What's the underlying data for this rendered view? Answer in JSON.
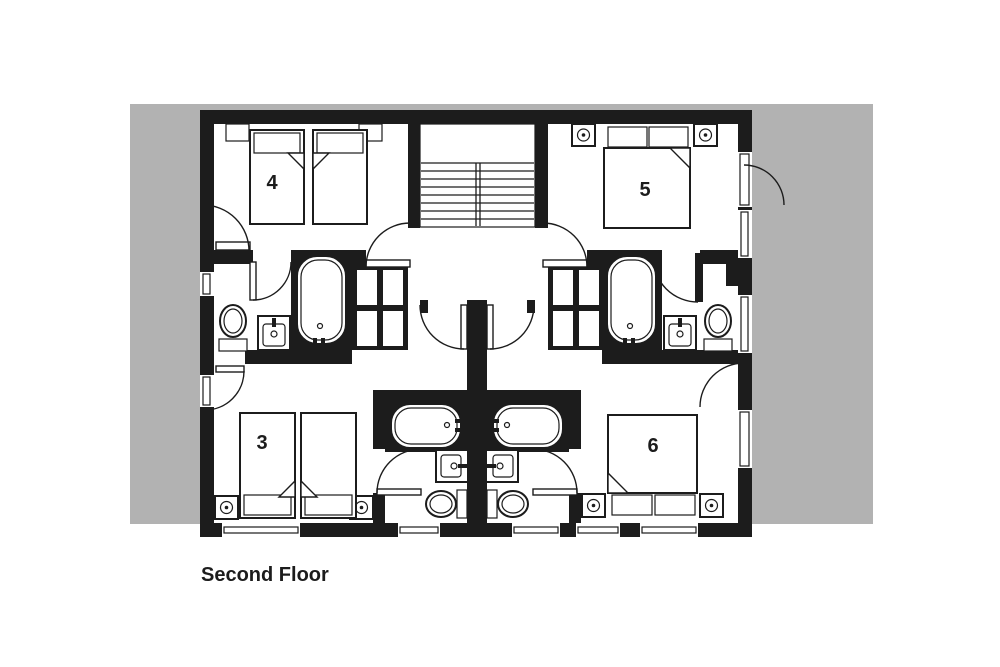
{
  "title": "Second Floor",
  "plan": {
    "rooms": [
      {
        "id": "room-3",
        "label": "3"
      },
      {
        "id": "room-4",
        "label": "4"
      },
      {
        "id": "room-5",
        "label": "5"
      },
      {
        "id": "room-6",
        "label": "6"
      }
    ],
    "colors": {
      "wall": "#1c1c1c",
      "backdrop": "#b2b2b2",
      "floor": "#ffffff"
    },
    "fixtures": [
      "staircase",
      "bathtub",
      "sink",
      "toilet",
      "wardrobe",
      "bed",
      "bedside-lamp",
      "door",
      "window"
    ]
  }
}
